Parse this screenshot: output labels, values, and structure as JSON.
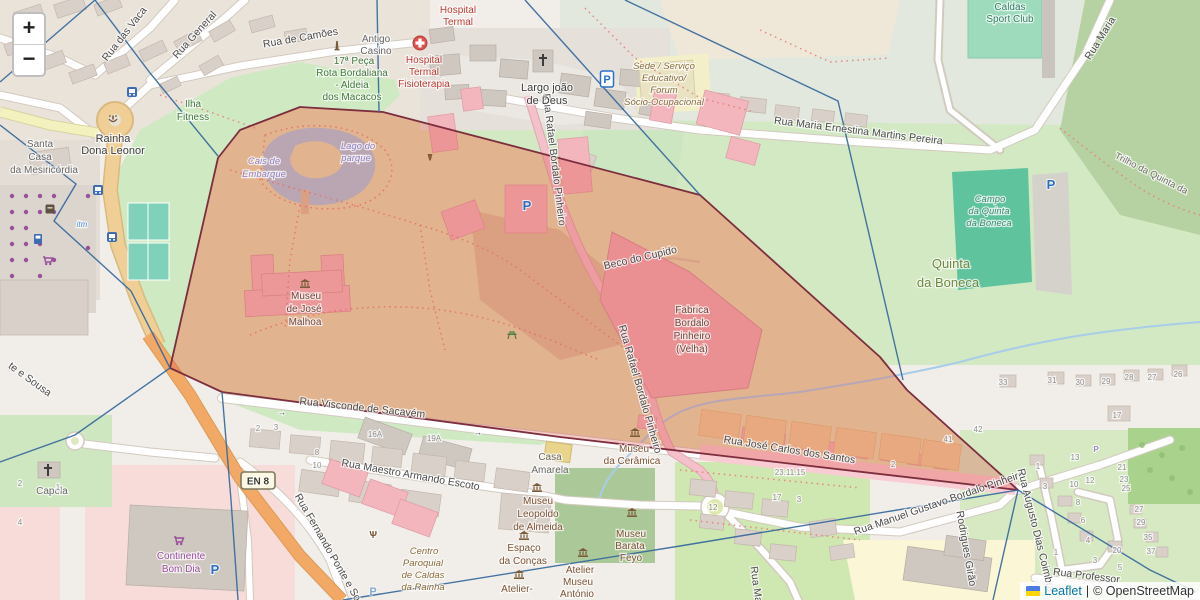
{
  "zoom_control": {
    "in": "+",
    "out": "−"
  },
  "attribution": {
    "leaflet": "Leaflet",
    "sep": "|",
    "copyright": "© OpenStreetMap"
  },
  "colors": {
    "overlay_fill": "#dd4b42",
    "overlay_opacity": "0.30",
    "overlay_stroke": "#7c2d3e",
    "graph_line": "#35689c",
    "link": "#0078A8",
    "flag_blue": "#4C7BE1",
    "flag_yellow": "#FFD500"
  },
  "map_labels": [
    {
      "t": "Rua das Vaca",
      "x": 127,
      "y": 36,
      "r": -52,
      "c": "st"
    },
    {
      "t": "Rua General",
      "x": 197,
      "y": 37,
      "r": -48,
      "c": "st"
    },
    {
      "t": "Rua de Camões",
      "x": 301,
      "y": 41,
      "r": -10,
      "c": "st"
    },
    {
      "t": "Rua Maria Ernestina Martins Pereira",
      "x": 858,
      "y": 134,
      "r": 7,
      "c": "st"
    },
    {
      "t": "Rua Maria",
      "x": 1103,
      "y": 40,
      "r": -58,
      "c": "st"
    },
    {
      "t": "Trilho da Quinta da",
      "x": 1150,
      "y": 176,
      "r": 27,
      "c": "path-lbl"
    },
    {
      "t": "Beco do Cupido",
      "x": 641,
      "y": 261,
      "r": -13,
      "c": "st"
    },
    {
      "t": "Rua Rafael Bordalo Pinheiro",
      "x": 551,
      "y": 160,
      "r": 83,
      "c": "st"
    },
    {
      "t": "Rua Rafael Bordalo Pinheiro",
      "x": 637,
      "y": 390,
      "r": 74,
      "c": "st"
    },
    {
      "t": "Rua Visconde de Sacavém",
      "x": 362,
      "y": 411,
      "r": 6,
      "c": "st"
    },
    {
      "t": "Rua Maestro Armando Escoto",
      "x": 410,
      "y": 478,
      "r": 10,
      "c": "st"
    },
    {
      "t": "Rua Fernando Ponte e So",
      "x": 325,
      "y": 549,
      "r": 60,
      "c": "st"
    },
    {
      "t": "te e Sousa",
      "x": 28,
      "y": 382,
      "r": 36,
      "c": "st"
    },
    {
      "t": "Rua José Carlos dos Santos",
      "x": 789,
      "y": 453,
      "r": 9,
      "c": "st"
    },
    {
      "t": "Rua Manuel Gustavo Bordalo Pinheiro",
      "x": 940,
      "y": 506,
      "r": -19,
      "c": "st"
    },
    {
      "t": "Rodrigues Girão",
      "x": 963,
      "y": 549,
      "r": 80,
      "c": "st"
    },
    {
      "t": "Rua Augusto Dias Coimbra",
      "x": 1033,
      "y": 531,
      "r": 76,
      "c": "st"
    },
    {
      "t": "Rua Professor",
      "x": 1086,
      "y": 579,
      "r": 7,
      "c": "st"
    },
    {
      "t": "Rua Ma",
      "x": 753,
      "y": 585,
      "r": 82,
      "c": "st"
    },
    {
      "t": "Antigo",
      "x": 376,
      "y": 42,
      "c": "gray"
    },
    {
      "t": "Casino",
      "x": 376,
      "y": 54,
      "c": "gray"
    },
    {
      "t": "17ª Peça",
      "x": 354,
      "y": 64,
      "c": "green"
    },
    {
      "t": "Rota Bordaliana",
      "x": 352,
      "y": 76,
      "c": "green"
    },
    {
      "t": "- Aldeia",
      "x": 352,
      "y": 88,
      "c": "green"
    },
    {
      "t": "dos Macacos",
      "x": 352,
      "y": 100,
      "c": "green"
    },
    {
      "t": "Hospital",
      "x": 458,
      "y": 13,
      "c": "red"
    },
    {
      "t": "Termal",
      "x": 458,
      "y": 25,
      "c": "red"
    },
    {
      "t": "Hospital",
      "x": 424,
      "y": 63,
      "c": "red"
    },
    {
      "t": "Termal",
      "x": 424,
      "y": 75,
      "c": "red"
    },
    {
      "t": "Fisioterapia",
      "x": 424,
      "y": 87,
      "c": "red"
    },
    {
      "t": "Largo joão",
      "x": 547,
      "y": 91,
      "c": "dark"
    },
    {
      "t": "de Deus",
      "x": 547,
      "y": 104,
      "c": "dark"
    },
    {
      "t": "Sede / Serviço",
      "x": 664,
      "y": 69,
      "c": "poi-it"
    },
    {
      "t": "Educativo/",
      "x": 664,
      "y": 81,
      "c": "poi-it"
    },
    {
      "t": "Forum",
      "x": 664,
      "y": 93,
      "c": "poi-it"
    },
    {
      "t": "Sócio-Ocupacional",
      "x": 664,
      "y": 105,
      "c": "poi-it"
    },
    {
      "t": "Caldas",
      "x": 1010,
      "y": 10,
      "c": "pitch"
    },
    {
      "t": "Sport Club",
      "x": 1010,
      "y": 22,
      "c": "pitch"
    },
    {
      "t": "Campo",
      "x": 990,
      "y": 202,
      "c": "pitch-it"
    },
    {
      "t": "da Quinta",
      "x": 989,
      "y": 214,
      "c": "pitch-it"
    },
    {
      "t": "da Boneca",
      "x": 989,
      "y": 226,
      "c": "pitch-it"
    },
    {
      "t": "Quinta",
      "x": 951,
      "y": 268,
      "c": "green2"
    },
    {
      "t": "da Boneca",
      "x": 948,
      "y": 287,
      "c": "green2"
    },
    {
      "t": "Ilha",
      "x": 193,
      "y": 107,
      "c": "green"
    },
    {
      "t": "Fitness",
      "x": 193,
      "y": 120,
      "c": "green"
    },
    {
      "t": "Santa",
      "x": 40,
      "y": 147,
      "c": "gray"
    },
    {
      "t": "Casa",
      "x": 40,
      "y": 160,
      "c": "gray"
    },
    {
      "t": "da Mesiricórdia",
      "x": 44,
      "y": 173,
      "c": "gray"
    },
    {
      "t": "Rainha",
      "x": 113,
      "y": 142,
      "c": "dark"
    },
    {
      "t": "Dona Leonor",
      "x": 113,
      "y": 154,
      "c": "dark"
    },
    {
      "t": "Lago do",
      "x": 358,
      "y": 149,
      "c": "water"
    },
    {
      "t": "parque",
      "x": 356,
      "y": 161,
      "c": "water"
    },
    {
      "t": "Cais de",
      "x": 264,
      "y": 164,
      "c": "water"
    },
    {
      "t": "Embarque",
      "x": 264,
      "y": 177,
      "c": "water"
    },
    {
      "t": "Museu",
      "x": 306,
      "y": 299,
      "c": "poi-dark"
    },
    {
      "t": "de José",
      "x": 304,
      "y": 312,
      "c": "poi-dark"
    },
    {
      "t": "Malhoa",
      "x": 305,
      "y": 325,
      "c": "poi-dark"
    },
    {
      "t": "Fabrica",
      "x": 692,
      "y": 313,
      "c": "poi-dark"
    },
    {
      "t": "Bordalo",
      "x": 692,
      "y": 326,
      "c": "poi-dark"
    },
    {
      "t": "Pinheiro",
      "x": 692,
      "y": 339,
      "c": "poi-dark"
    },
    {
      "t": "(Velha)",
      "x": 692,
      "y": 352,
      "c": "poi-dark"
    },
    {
      "t": "Museu",
      "x": 634,
      "y": 452,
      "c": "poi"
    },
    {
      "t": "da Cerâmica",
      "x": 632,
      "y": 464,
      "c": "poi"
    },
    {
      "t": "Casa",
      "x": 550,
      "y": 460,
      "c": "gray"
    },
    {
      "t": "Amarela",
      "x": 550,
      "y": 473,
      "c": "gray"
    },
    {
      "t": "Museu",
      "x": 538,
      "y": 504,
      "c": "poi"
    },
    {
      "t": "Leopoldo",
      "x": 538,
      "y": 517,
      "c": "poi"
    },
    {
      "t": "de Almeida",
      "x": 538,
      "y": 530,
      "c": "poi"
    },
    {
      "t": "Espaço",
      "x": 524,
      "y": 551,
      "c": "poi"
    },
    {
      "t": "da Conças",
      "x": 523,
      "y": 564,
      "c": "poi"
    },
    {
      "t": "Museu",
      "x": 631,
      "y": 537,
      "c": "poi"
    },
    {
      "t": "Barata",
      "x": 630,
      "y": 549,
      "c": "poi"
    },
    {
      "t": "Feyo",
      "x": 631,
      "y": 561,
      "c": "poi"
    },
    {
      "t": "Atelier",
      "x": 580,
      "y": 573,
      "c": "poi"
    },
    {
      "t": "Museu",
      "x": 578,
      "y": 585,
      "c": "poi"
    },
    {
      "t": "António",
      "x": 577,
      "y": 597,
      "c": "poi"
    },
    {
      "t": "Atelier-",
      "x": 517,
      "y": 592,
      "c": "poi"
    },
    {
      "t": "Centro",
      "x": 424,
      "y": 554,
      "c": "poi-it"
    },
    {
      "t": "Paroquial",
      "x": 423,
      "y": 566,
      "c": "poi-it"
    },
    {
      "t": "de Caldas",
      "x": 423,
      "y": 578,
      "c": "poi-it"
    },
    {
      "t": "da Rainha",
      "x": 423,
      "y": 590,
      "c": "poi-it"
    },
    {
      "t": "Continente",
      "x": 181,
      "y": 559,
      "c": "purple"
    },
    {
      "t": "Bom Dia",
      "x": 181,
      "y": 572,
      "c": "purple"
    },
    {
      "t": "Capela",
      "x": 52,
      "y": 494,
      "c": "gray"
    },
    {
      "t": "itm",
      "x": 82,
      "y": 227,
      "c": "blue-sm"
    },
    {
      "t": "2",
      "x": 258,
      "y": 431,
      "c": "hn"
    },
    {
      "t": "3",
      "x": 276,
      "y": 430,
      "c": "hn"
    },
    {
      "t": "16A",
      "x": 375,
      "y": 437,
      "c": "hn"
    },
    {
      "t": "19A",
      "x": 434,
      "y": 441,
      "c": "hn"
    },
    {
      "t": "8",
      "x": 317,
      "y": 455,
      "c": "hn"
    },
    {
      "t": "10",
      "x": 317,
      "y": 468,
      "c": "hn"
    },
    {
      "t": "33",
      "x": 1003,
      "y": 385,
      "c": "hn"
    },
    {
      "t": "31",
      "x": 1052,
      "y": 383,
      "c": "hn"
    },
    {
      "t": "30",
      "x": 1080,
      "y": 385,
      "c": "hn"
    },
    {
      "t": "29",
      "x": 1106,
      "y": 384,
      "c": "hn"
    },
    {
      "t": "28",
      "x": 1129,
      "y": 380,
      "c": "hn"
    },
    {
      "t": "27",
      "x": 1152,
      "y": 380,
      "c": "hn"
    },
    {
      "t": "26",
      "x": 1178,
      "y": 377,
      "c": "hn"
    },
    {
      "t": "17",
      "x": 1117,
      "y": 418,
      "c": "hn"
    },
    {
      "t": "13",
      "x": 1075,
      "y": 460,
      "c": "hn"
    },
    {
      "t": "1",
      "x": 1038,
      "y": 469,
      "c": "hn"
    },
    {
      "t": "3",
      "x": 1045,
      "y": 489,
      "c": "hn"
    },
    {
      "t": "12",
      "x": 1090,
      "y": 483,
      "c": "hn"
    },
    {
      "t": "10",
      "x": 1074,
      "y": 487,
      "c": "hn"
    },
    {
      "t": "21",
      "x": 1122,
      "y": 470,
      "c": "hn"
    },
    {
      "t": "23",
      "x": 1124,
      "y": 482,
      "c": "hn"
    },
    {
      "t": "25",
      "x": 1126,
      "y": 491,
      "c": "hn"
    },
    {
      "t": "27",
      "x": 1139,
      "y": 512,
      "c": "hn"
    },
    {
      "t": "29",
      "x": 1141,
      "y": 525,
      "c": "hn"
    },
    {
      "t": "35",
      "x": 1148,
      "y": 540,
      "c": "hn"
    },
    {
      "t": "37",
      "x": 1151,
      "y": 554,
      "c": "hn"
    },
    {
      "t": "1",
      "x": 1056,
      "y": 555,
      "c": "hn"
    },
    {
      "t": "3",
      "x": 1095,
      "y": 563,
      "c": "hn"
    },
    {
      "t": "5",
      "x": 1120,
      "y": 570,
      "c": "hn"
    },
    {
      "t": "20",
      "x": 1117,
      "y": 553,
      "c": "hn"
    },
    {
      "t": "6",
      "x": 1083,
      "y": 523,
      "c": "hn"
    },
    {
      "t": "8",
      "x": 1078,
      "y": 505,
      "c": "hn"
    },
    {
      "t": "4",
      "x": 1088,
      "y": 543,
      "c": "hn"
    },
    {
      "t": "42",
      "x": 978,
      "y": 432,
      "c": "hn"
    },
    {
      "t": "41",
      "x": 948,
      "y": 442,
      "c": "hn"
    },
    {
      "t": "2",
      "x": 893,
      "y": 467,
      "c": "hn"
    },
    {
      "t": "23.11.15",
      "x": 790,
      "y": 475,
      "c": "hn"
    },
    {
      "t": "17",
      "x": 777,
      "y": 500,
      "c": "hn"
    },
    {
      "t": "3",
      "x": 799,
      "y": 502,
      "c": "hn"
    },
    {
      "t": "12",
      "x": 713,
      "y": 510,
      "c": "hn"
    },
    {
      "t": "2",
      "x": 20,
      "y": 486,
      "c": "hn"
    },
    {
      "t": "1",
      "x": 58,
      "y": 490,
      "c": "hn"
    },
    {
      "t": "4",
      "x": 20,
      "y": 525,
      "c": "hn"
    }
  ],
  "map_icons": [
    {
      "name": "museum-icon",
      "k": "museum",
      "x": 305,
      "y": 284
    },
    {
      "name": "museum-icon",
      "k": "museum",
      "x": 635,
      "y": 433
    },
    {
      "name": "museum-icon",
      "k": "museum",
      "x": 537,
      "y": 488
    },
    {
      "name": "museum-icon",
      "k": "museum",
      "x": 524,
      "y": 536
    },
    {
      "name": "museum-icon",
      "k": "museum",
      "x": 632,
      "y": 513
    },
    {
      "name": "museum-icon",
      "k": "museum",
      "x": 583,
      "y": 553
    },
    {
      "name": "museum-icon",
      "k": "museum",
      "x": 519,
      "y": 575
    },
    {
      "name": "church-cross-icon",
      "k": "cross",
      "x": 543,
      "y": 60
    },
    {
      "name": "chapel-cross-icon",
      "k": "cross",
      "x": 48,
      "y": 470
    },
    {
      "name": "hospital-icon",
      "k": "hospital",
      "x": 420,
      "y": 43
    },
    {
      "name": "parking-icon",
      "k": "p",
      "t": "P",
      "x": 527,
      "y": 205
    },
    {
      "name": "parking-icon",
      "k": "p",
      "t": "P",
      "x": 1051,
      "y": 184
    },
    {
      "name": "parking-icon",
      "k": "p",
      "t": "P",
      "x": 215,
      "y": 569
    },
    {
      "name": "parking-icon",
      "k": "p-faint",
      "t": "P",
      "x": 373,
      "y": 591
    },
    {
      "name": "parking-boxed-icon",
      "k": "pbox",
      "t": "P",
      "x": 607,
      "y": 79
    },
    {
      "name": "private-parking-icon",
      "k": "p-sm",
      "t": "P",
      "x": 1096,
      "y": 449
    },
    {
      "name": "bus-stop-icon",
      "k": "bus",
      "x": 132,
      "y": 92
    },
    {
      "name": "bus-stop-icon",
      "k": "bus",
      "x": 98,
      "y": 190
    },
    {
      "name": "bus-stop-icon",
      "k": "bus",
      "x": 112,
      "y": 237
    },
    {
      "name": "monument-icon",
      "k": "monument",
      "x": 337,
      "y": 45
    },
    {
      "name": "fountain-icon",
      "k": "fountain",
      "x": 113,
      "y": 119
    },
    {
      "name": "supermarket-icon",
      "k": "cart",
      "x": 179,
      "y": 540
    },
    {
      "name": "supermarket-icon",
      "k": "cart",
      "x": 48,
      "y": 260
    },
    {
      "name": "fuel-icon",
      "k": "fuel",
      "x": 38,
      "y": 239
    },
    {
      "name": "kiosk-icon",
      "k": "kiosk",
      "x": 50,
      "y": 209
    },
    {
      "name": "picnic-icon",
      "k": "picnic",
      "x": 512,
      "y": 335
    },
    {
      "name": "worship-icon",
      "k": "psi",
      "t": "Ѱ",
      "x": 373,
      "y": 534
    },
    {
      "name": "urn-icon",
      "k": "urn",
      "x": 430,
      "y": 157
    },
    {
      "name": "oneway-arrow-icon",
      "k": "arrow",
      "t": "→",
      "x": 282,
      "y": 412,
      "r": 6
    },
    {
      "name": "oneway-arrow-icon",
      "k": "arrow",
      "t": "→",
      "x": 478,
      "y": 432,
      "r": 8
    },
    {
      "name": "highway-badge",
      "k": "en8",
      "t": "EN 8",
      "x": 258,
      "y": 481
    }
  ]
}
